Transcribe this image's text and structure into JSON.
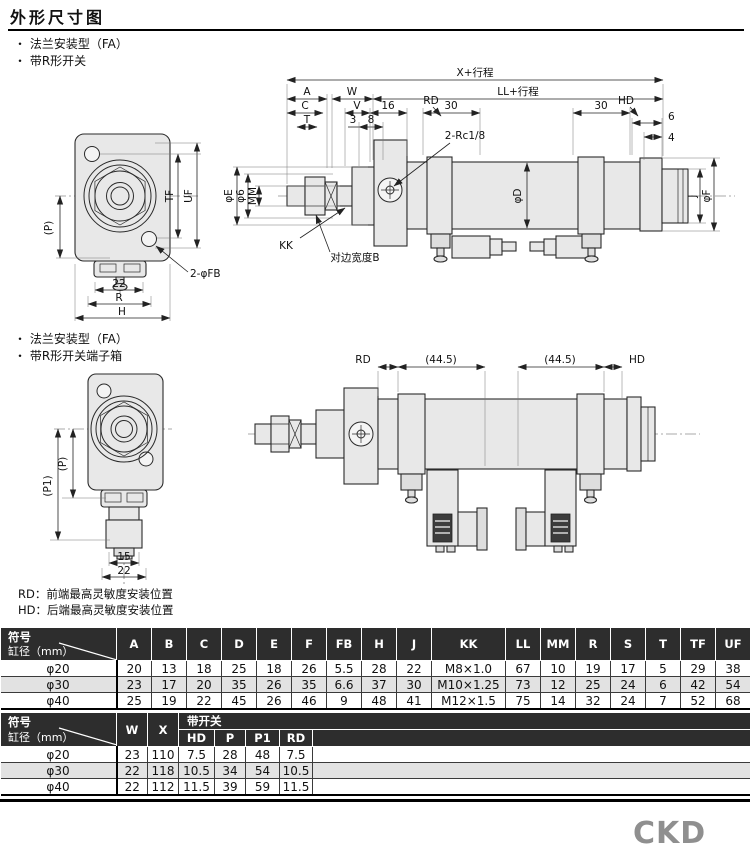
{
  "page": {
    "title": "外形尺寸图",
    "logo": "CKD"
  },
  "section1": {
    "bullet1": "法兰安装型（FA）",
    "bullet2": "带R形开关"
  },
  "section2": {
    "bullet1": "法兰安装型（FA）",
    "bullet2": "带R形开关端子箱"
  },
  "notes": {
    "rd": "RD：前端最高灵敏度安装位置",
    "hd": "HD：后端最高灵敏度安装位置"
  },
  "drawing1": {
    "dims": {
      "x_stroke": "X+行程",
      "ll_stroke": "LL+行程",
      "a": "A",
      "w": "W",
      "c": "C",
      "v": "V",
      "n16": "16",
      "t": "T",
      "n3": "3",
      "n8": "8",
      "rd": "RD",
      "n30a": "30",
      "n30b": "30",
      "hd": "HD",
      "n6": "6",
      "n4": "4",
      "rc_port": "2-Rc1/8",
      "phi_e": "φE",
      "phi_6": "φ6",
      "mm": "MM",
      "kk": "KK",
      "flats_b": "对边宽度B",
      "phi_d": "φD",
      "j": "J",
      "phi_f": "φF",
      "p": "(P)",
      "tf": "TF",
      "uf": "UF",
      "fb": "2-φFB",
      "n22": "22",
      "r": "R",
      "h": "H"
    }
  },
  "drawing2": {
    "dims": {
      "rd": "RD",
      "l445a": "(44.5)",
      "l445b": "(44.5)",
      "hd": "HD",
      "p": "(P)",
      "p1": "(P1)",
      "n15": "15",
      "n22": "22"
    }
  },
  "table1": {
    "corner": {
      "top": "符号",
      "bottom": "缸径（mm）"
    },
    "columns": [
      "A",
      "B",
      "C",
      "D",
      "E",
      "F",
      "FB",
      "H",
      "J",
      "KK",
      "LL",
      "MM",
      "R",
      "S",
      "T",
      "TF",
      "UF",
      "V"
    ],
    "rows": [
      {
        "label": "φ20",
        "values": [
          "20",
          "13",
          "18",
          "25",
          "18",
          "26",
          "5.5",
          "28",
          "22",
          "M8×1.0",
          "67",
          "10",
          "19",
          "17",
          "5",
          "29",
          "38",
          "12"
        ]
      },
      {
        "label": "φ30",
        "values": [
          "23",
          "17",
          "20",
          "35",
          "26",
          "35",
          "6.6",
          "37",
          "30",
          "M10×1.25",
          "73",
          "12",
          "25",
          "24",
          "6",
          "42",
          "54",
          "15"
        ]
      },
      {
        "label": "φ40",
        "values": [
          "25",
          "19",
          "22",
          "45",
          "26",
          "46",
          "9",
          "48",
          "41",
          "M12×1.5",
          "75",
          "14",
          "32",
          "24",
          "7",
          "52",
          "68",
          "16"
        ]
      }
    ]
  },
  "table2": {
    "corner": {
      "top": "符号",
      "bottom": "缸径（mm）"
    },
    "group": "带开关",
    "columns": [
      "W",
      "X",
      "HD",
      "P",
      "P1",
      "RD"
    ],
    "rows": [
      {
        "label": "φ20",
        "values": [
          "23",
          "110",
          "7.5",
          "28",
          "48",
          "7.5"
        ]
      },
      {
        "label": "φ30",
        "values": [
          "22",
          "118",
          "10.5",
          "34",
          "54",
          "10.5"
        ]
      },
      {
        "label": "φ40",
        "values": [
          "22",
          "112",
          "11.5",
          "39",
          "59",
          "11.5"
        ]
      }
    ]
  }
}
